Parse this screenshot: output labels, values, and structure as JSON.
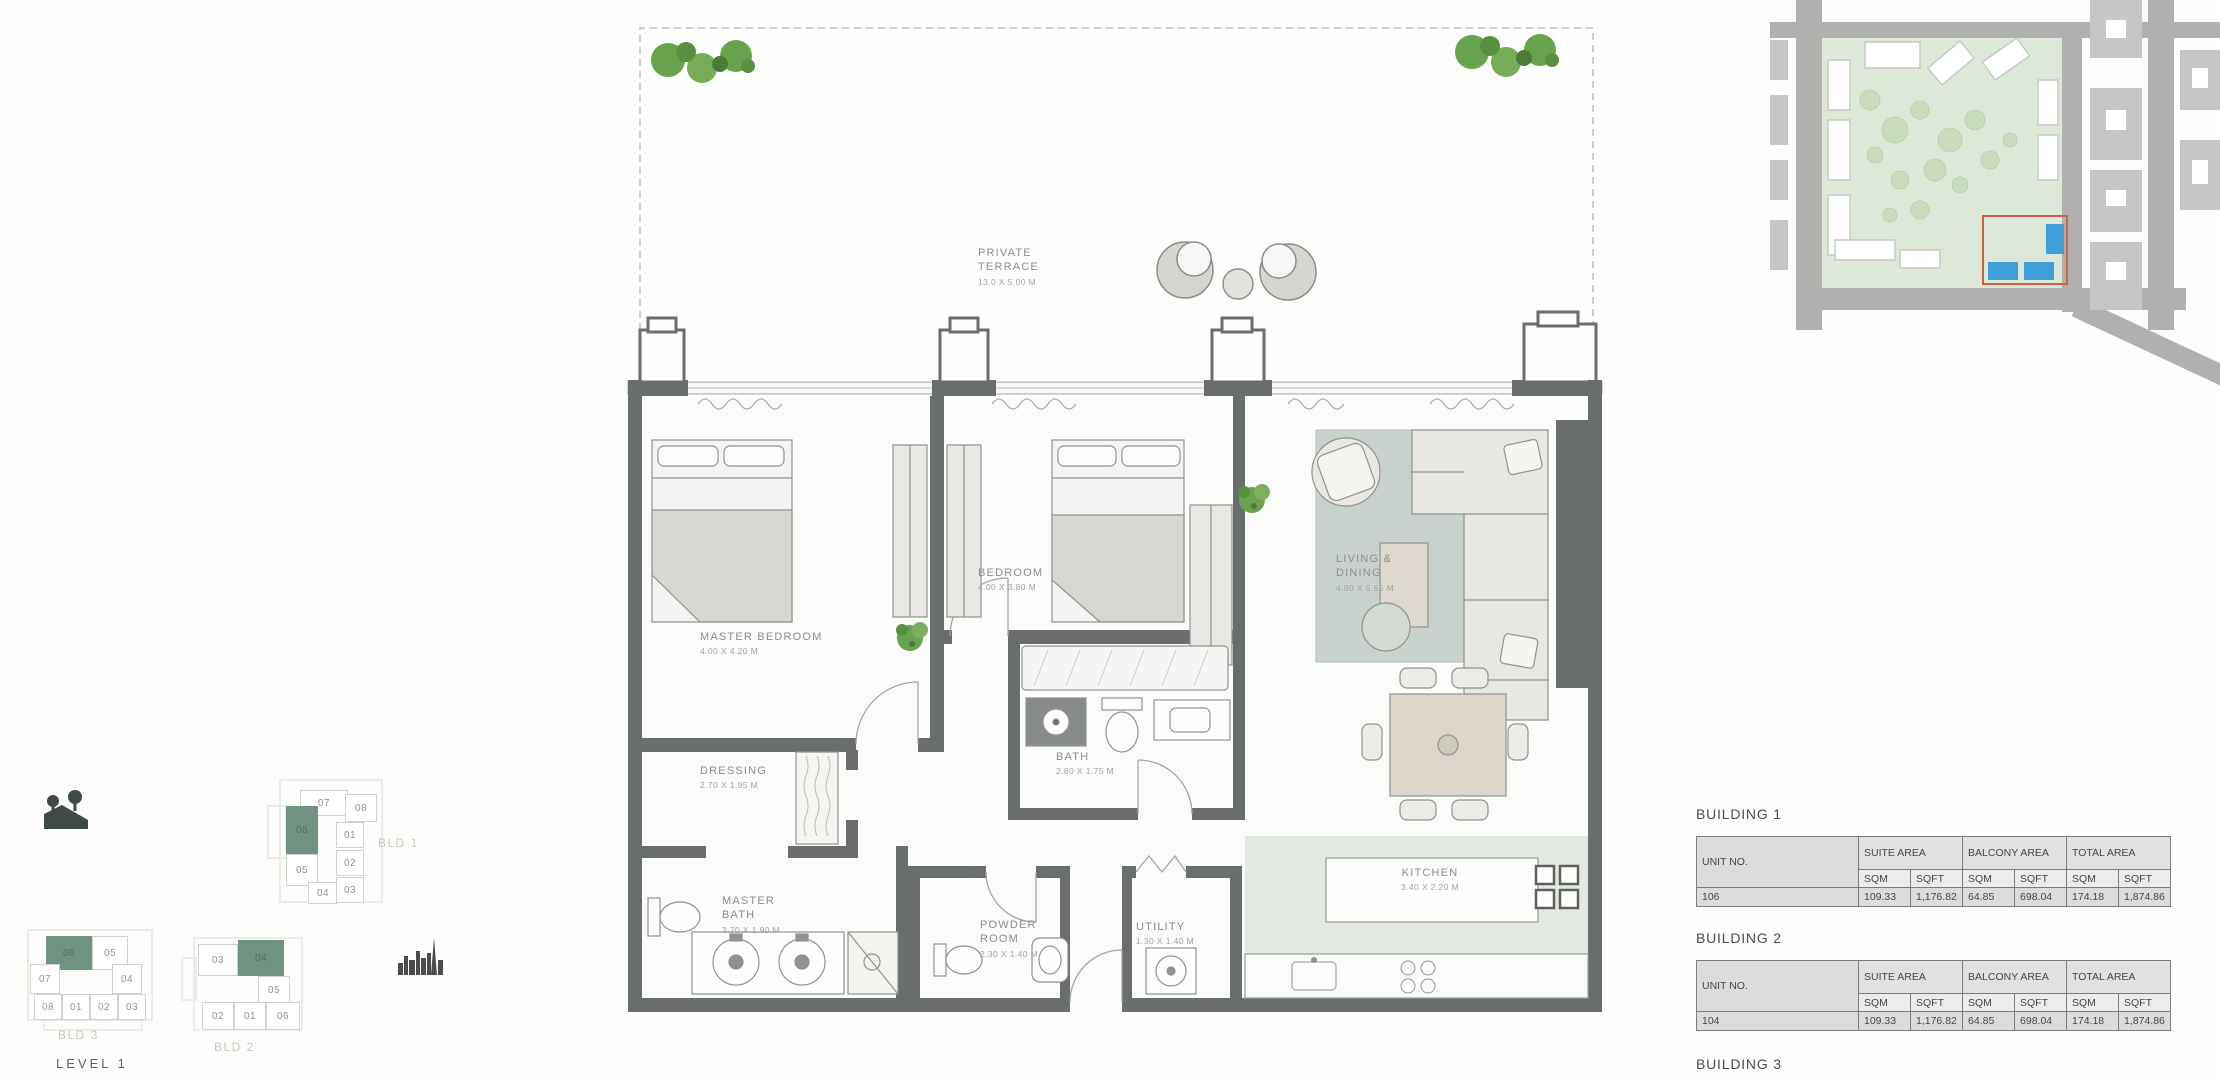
{
  "floor_plan": {
    "rooms": [
      {
        "name": "PRIVATE TERRACE",
        "dims": "13.0 X 5.00 M"
      },
      {
        "name": "MASTER BEDROOM",
        "dims": "4.00 X 4.20 M"
      },
      {
        "name": "BEDROOM",
        "dims": "4.00 X 3.80 M"
      },
      {
        "name": "LIVING & DINING",
        "dims": "4.80 X 5.65 M"
      },
      {
        "name": "DRESSING",
        "dims": "2.70 X 1.95 M"
      },
      {
        "name": "MASTER BATH",
        "dims": "3.70 X 1.90 M"
      },
      {
        "name": "BATH",
        "dims": "2.80 X 1.75 M"
      },
      {
        "name": "POWDER ROOM",
        "dims": "2.30 X 1.40 M"
      },
      {
        "name": "UTILITY",
        "dims": "1.30 X 1.40 M"
      },
      {
        "name": "KITCHEN",
        "dims": "3.40 X 2.20 M"
      }
    ]
  },
  "level_nav": {
    "title": "LEVEL 1",
    "highlight_color": "#6f9282",
    "bld1": {
      "label": "BLD 1",
      "highlighted_unit": "06",
      "units": [
        "07",
        "08",
        "06",
        "01",
        "05",
        "02",
        "04",
        "03"
      ]
    },
    "bld2": {
      "label": "BLD 2",
      "highlighted_unit": "04",
      "units": [
        "03",
        "04",
        "05",
        "02",
        "01",
        "06"
      ]
    },
    "bld3": {
      "label": "BLD 3",
      "highlighted_unit": "06",
      "units": [
        "06",
        "05",
        "07",
        "04",
        "08",
        "01",
        "02",
        "03"
      ]
    }
  },
  "area_tables": {
    "headers": {
      "unit": "UNIT NO.",
      "suite": "SUITE AREA",
      "balcony": "BALCONY AREA",
      "total": "TOTAL AREA",
      "sqm": "SQM",
      "sqft": "SQFT"
    },
    "building1": {
      "title": "BUILDING 1",
      "unit_no": "106",
      "suite_sqm": "109.33",
      "suite_sqft": "1,176.82",
      "balcony_sqm": "64.85",
      "balcony_sqft": "698.04",
      "total_sqm": "174.18",
      "total_sqft": "1,874.86"
    },
    "building2": {
      "title": "BUILDING 2",
      "unit_no": "104",
      "suite_sqm": "109.33",
      "suite_sqft": "1,176.82",
      "balcony_sqm": "64.85",
      "balcony_sqft": "698.04",
      "total_sqm": "174.18",
      "total_sqft": "1,874.86"
    },
    "building3": {
      "title": "BUILDING 3"
    }
  }
}
